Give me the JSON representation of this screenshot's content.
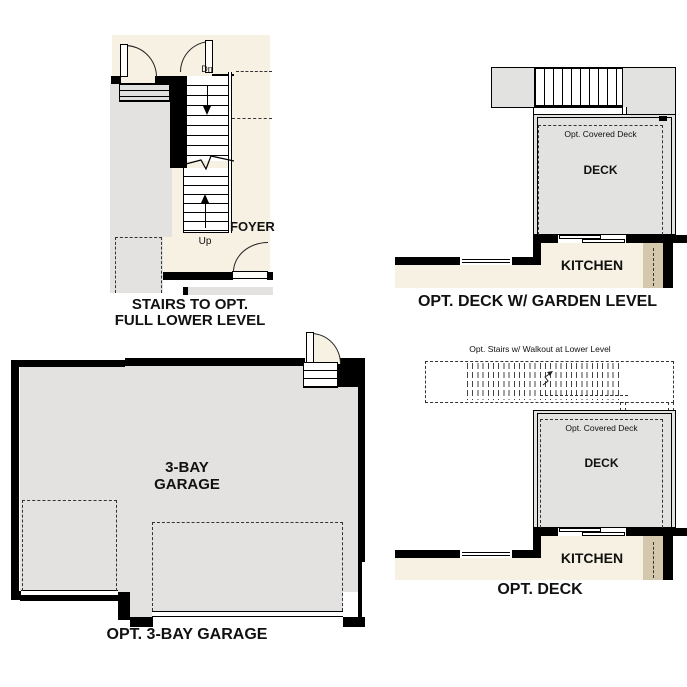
{
  "colors": {
    "cream": "#F7F1E3",
    "room_gray": "#E3E2E0",
    "deck_gray": "#E2E2E0",
    "tan": "#D4C8AC",
    "wall_black": "#000000"
  },
  "stairs_plan": {
    "title_line1": "STAIRS TO OPT.",
    "title_line2": "FULL LOWER LEVEL",
    "dn": "Dn",
    "up": "Up",
    "foyer": "FOYER"
  },
  "garden_deck_plan": {
    "title": "OPT. DECK W/ GARDEN LEVEL",
    "covered_deck": "Opt. Covered Deck",
    "deck": "DECK",
    "kitchen": "KITCHEN"
  },
  "garage_plan": {
    "title": "OPT. 3-BAY GARAGE",
    "label_line1": "3-BAY",
    "label_line2": "GARAGE"
  },
  "deck_plan": {
    "title": "OPT. DECK",
    "stairs_note": "Opt. Stairs w/ Walkout at Lower Level",
    "covered_deck": "Opt. Covered Deck",
    "deck": "DECK",
    "kitchen": "KITCHEN"
  }
}
